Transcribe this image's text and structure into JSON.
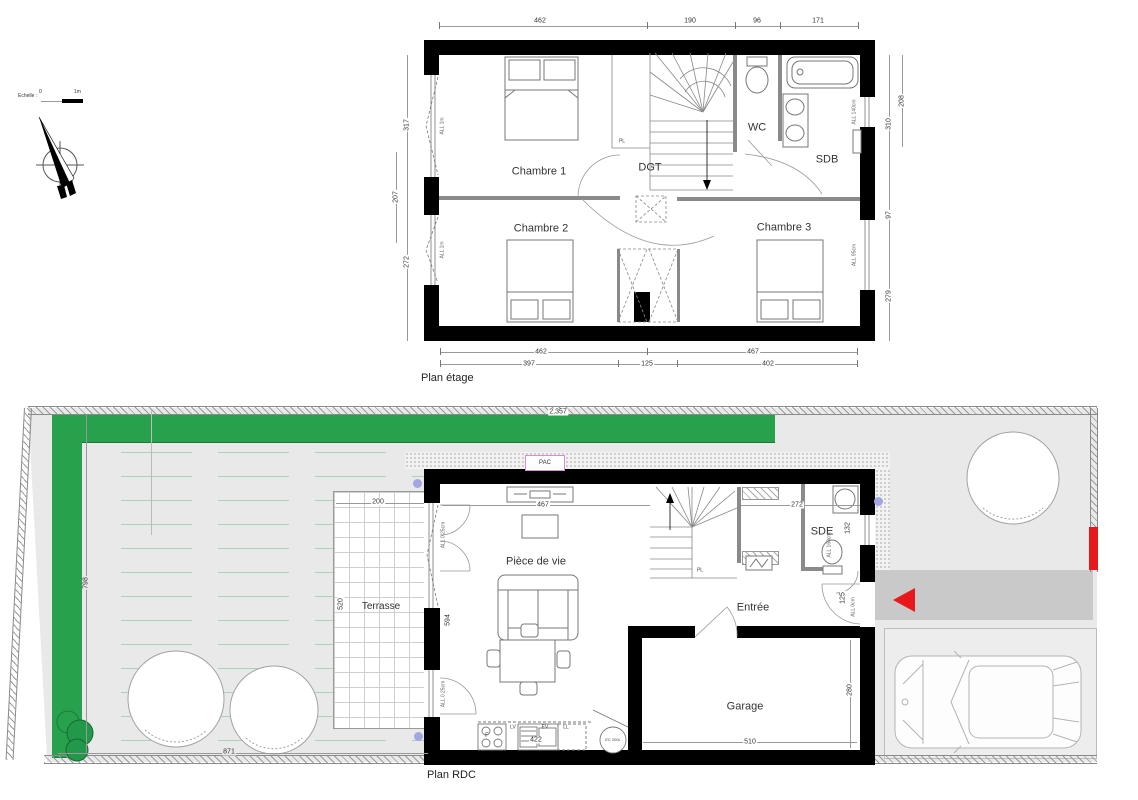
{
  "scale": {
    "label": "Echelle :",
    "t0": "0",
    "t1": "1m"
  },
  "etage": {
    "title": "Plan étage",
    "rooms": {
      "c1": "Chambre 1",
      "c2": "Chambre 2",
      "c3": "Chambre 3",
      "dgt": "DGT",
      "wc": "WC",
      "sdb": "SDB",
      "pl": "PL"
    },
    "dims": {
      "top": [
        "462",
        "190",
        "96",
        "171"
      ],
      "left": [
        "317",
        "207",
        "272"
      ],
      "right": [
        "310",
        "97",
        "279",
        "208"
      ],
      "bottom1": [
        "462",
        "467"
      ],
      "bottom2": [
        "397",
        "125",
        "402"
      ]
    },
    "win": {
      "l1": "ALL 1m",
      "l2": "ALL 1m",
      "r1": "ALL 140cm",
      "r2": "ALL 95cm"
    }
  },
  "rdc": {
    "title": "Plan RDC",
    "rooms": {
      "living": "Pièce de vie",
      "terrasse": "Terrasse",
      "entree": "Entrée",
      "garage": "Garage",
      "sde": "SDE",
      "pl": "PL",
      "pac": "PAC"
    },
    "dims": {
      "site_top": "2,357",
      "site_left": "798",
      "site_bottom": "871",
      "terr_w": "200",
      "terr_h": "520",
      "living_w": "467",
      "living_h": "594",
      "hall_w": "272",
      "sde_win": "132",
      "entry_win": "125",
      "garage_h": "280",
      "garage_w": "510",
      "kitchen_w": "422"
    },
    "win": {
      "bay1": "ALL 0.25cm",
      "bay2": "ALL 0.25cm",
      "sde": "ALL 160cm",
      "door": "ALL 0cm"
    },
    "kitchen": {
      "f": "F",
      "lv": "LV",
      "ev": "EV",
      "ll": "LL",
      "ec": "EC 200L"
    }
  }
}
